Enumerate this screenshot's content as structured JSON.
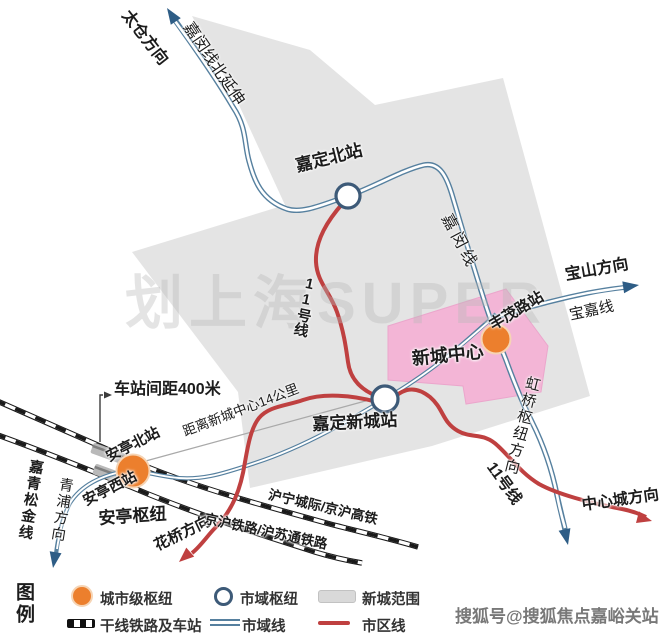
{
  "map": {
    "stations": {
      "jiading_north": "嘉定北站",
      "fengmao_road": "丰茂路站",
      "jiading_xincheng": "嘉定新城站",
      "anting_north": "安亭北站",
      "anting_west": "安亭西站",
      "anting_hub": "安亭枢纽",
      "xincheng_center": "新城中心"
    },
    "lines": {
      "jiamin_north_ext": "嘉闵线北延伸",
      "jiamin": "嘉闵线",
      "baojia": "宝嘉线",
      "jiaqingsongjin": "嘉青松金线",
      "line11": "11号线",
      "huning_jinghu_hsr": "沪宁城际/京沪高铁",
      "jinghu_husutong": "京沪铁路/沪苏通铁路"
    },
    "directions": {
      "taicang": "太仓方向",
      "baoshan": "宝山方向",
      "qingpu": "青浦方向",
      "huaqiao": "花桥方向",
      "central_city": "中心城方向",
      "hongqiao_hub": "虹桥枢纽方向"
    },
    "annotations": {
      "station_spacing": "车站间距400米",
      "distance_to_center": "距离新城中心14公里"
    }
  },
  "legend": {
    "title": "图例",
    "items": {
      "city_hub": "城市级枢纽",
      "regional_hub": "市域枢纽",
      "xincheng_area": "新城范围",
      "trunk_railway": "干线铁路及车站",
      "regional_line": "市域线",
      "urban_line": "市区线"
    }
  },
  "watermarks": {
    "center": "划上海SUPER",
    "bottom_right": "搜狐号@搜狐焦点嘉峪关站"
  },
  "colors": {
    "regional_line_blue": "#56809f",
    "urban_line_red": "#bf4040",
    "hub_orange": "#ec7f2d",
    "xincheng_area_gray": "#dddddd",
    "xincheng_center_pink": "#f3b5d6",
    "railway_black": "#1a1a1a"
  }
}
